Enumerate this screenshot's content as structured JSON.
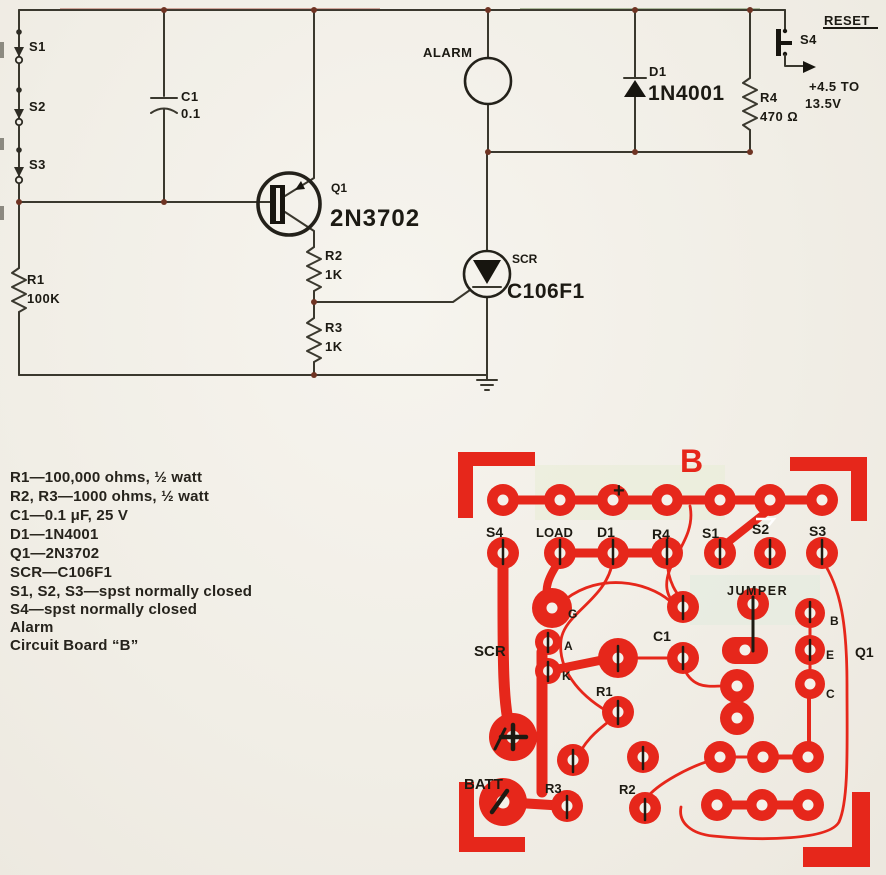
{
  "schematic": {
    "labels": {
      "s1": "S1",
      "s2": "S2",
      "s3": "S3",
      "r1_ref": "R1",
      "r1_val": "100K",
      "c1_ref": "C1",
      "c1_val": "0.1",
      "q1_ref": "Q1",
      "q1_val": "2N3702",
      "r2_ref": "R2",
      "r2_val": "1K",
      "r3_ref": "R3",
      "r3_val": "1K",
      "alarm": "ALARM",
      "scr_ref": "SCR",
      "scr_val": "C106F1",
      "d1_ref": "D1",
      "d1_val": "1N4001",
      "r4_ref": "R4",
      "r4_val": "470 Ω",
      "s4": "S4",
      "reset": "RESET",
      "supply_line1": "+4.5 TO",
      "supply_line2": "13.5V"
    }
  },
  "parts_list": {
    "items": [
      "R1—100,000 ohms, ½ watt",
      "R2, R3—1000 ohms, ½ watt",
      "C1—0.1 μF, 25 V",
      "D1—1N4001",
      "Q1—2N3702",
      "SCR—C106F1",
      "S1, S2, S3—spst normally closed",
      "S4—spst normally closed",
      "Alarm",
      "Circuit Board “B”"
    ]
  },
  "pcb": {
    "board_label": "B",
    "colors": {
      "copper": "#e6271b",
      "silkscreen": "#1d1a12"
    },
    "silkscreen": {
      "s4": "S4",
      "load": "LOAD",
      "d1": "D1",
      "r4": "R4",
      "s1": "S1",
      "s2": "S2",
      "s3": "S3",
      "plus_top": "+",
      "jumper": "JUMPER",
      "c1": "C1",
      "scr": "SCR",
      "pin_g": "G",
      "pin_a": "A",
      "pin_k": "K",
      "r1": "R1",
      "batt": "BATT",
      "r3": "R3",
      "r2": "R2",
      "q1": "Q1",
      "pin_b": "B",
      "pin_e": "E",
      "pin_c": "C"
    }
  }
}
